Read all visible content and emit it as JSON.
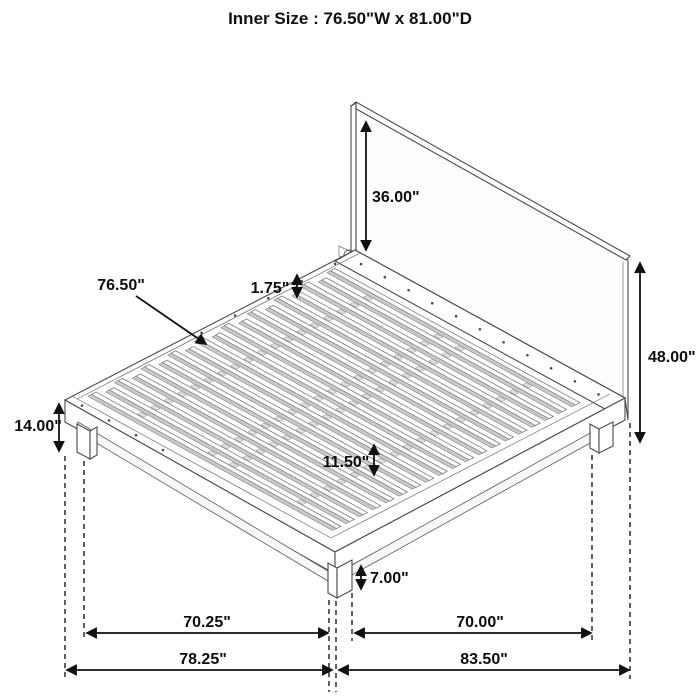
{
  "title": "Inner Size : 76.50\"W x 81.00\"D",
  "diagram": {
    "labels": {
      "headboard_height": "36.00\"",
      "slat_length": "76.50\"",
      "slat_thickness": "1.75\"",
      "overall_height": "48.00\"",
      "platform_height": "14.00\"",
      "center_rail_spacing": "11.50\"",
      "leg_height": "7.00\"",
      "leg_span_width": "70.25\"",
      "leg_span_depth": "70.00\"",
      "overall_width": "78.25\"",
      "overall_depth": "83.50\""
    },
    "slat_count": 19,
    "colors": {
      "line": "#4a4a4a",
      "dimension": "#111111",
      "slat_fill": "#fdfdfd",
      "slat_shadow": "#c9c9c9",
      "tab_fill": "#e2e2e2",
      "background": "#ffffff"
    }
  }
}
